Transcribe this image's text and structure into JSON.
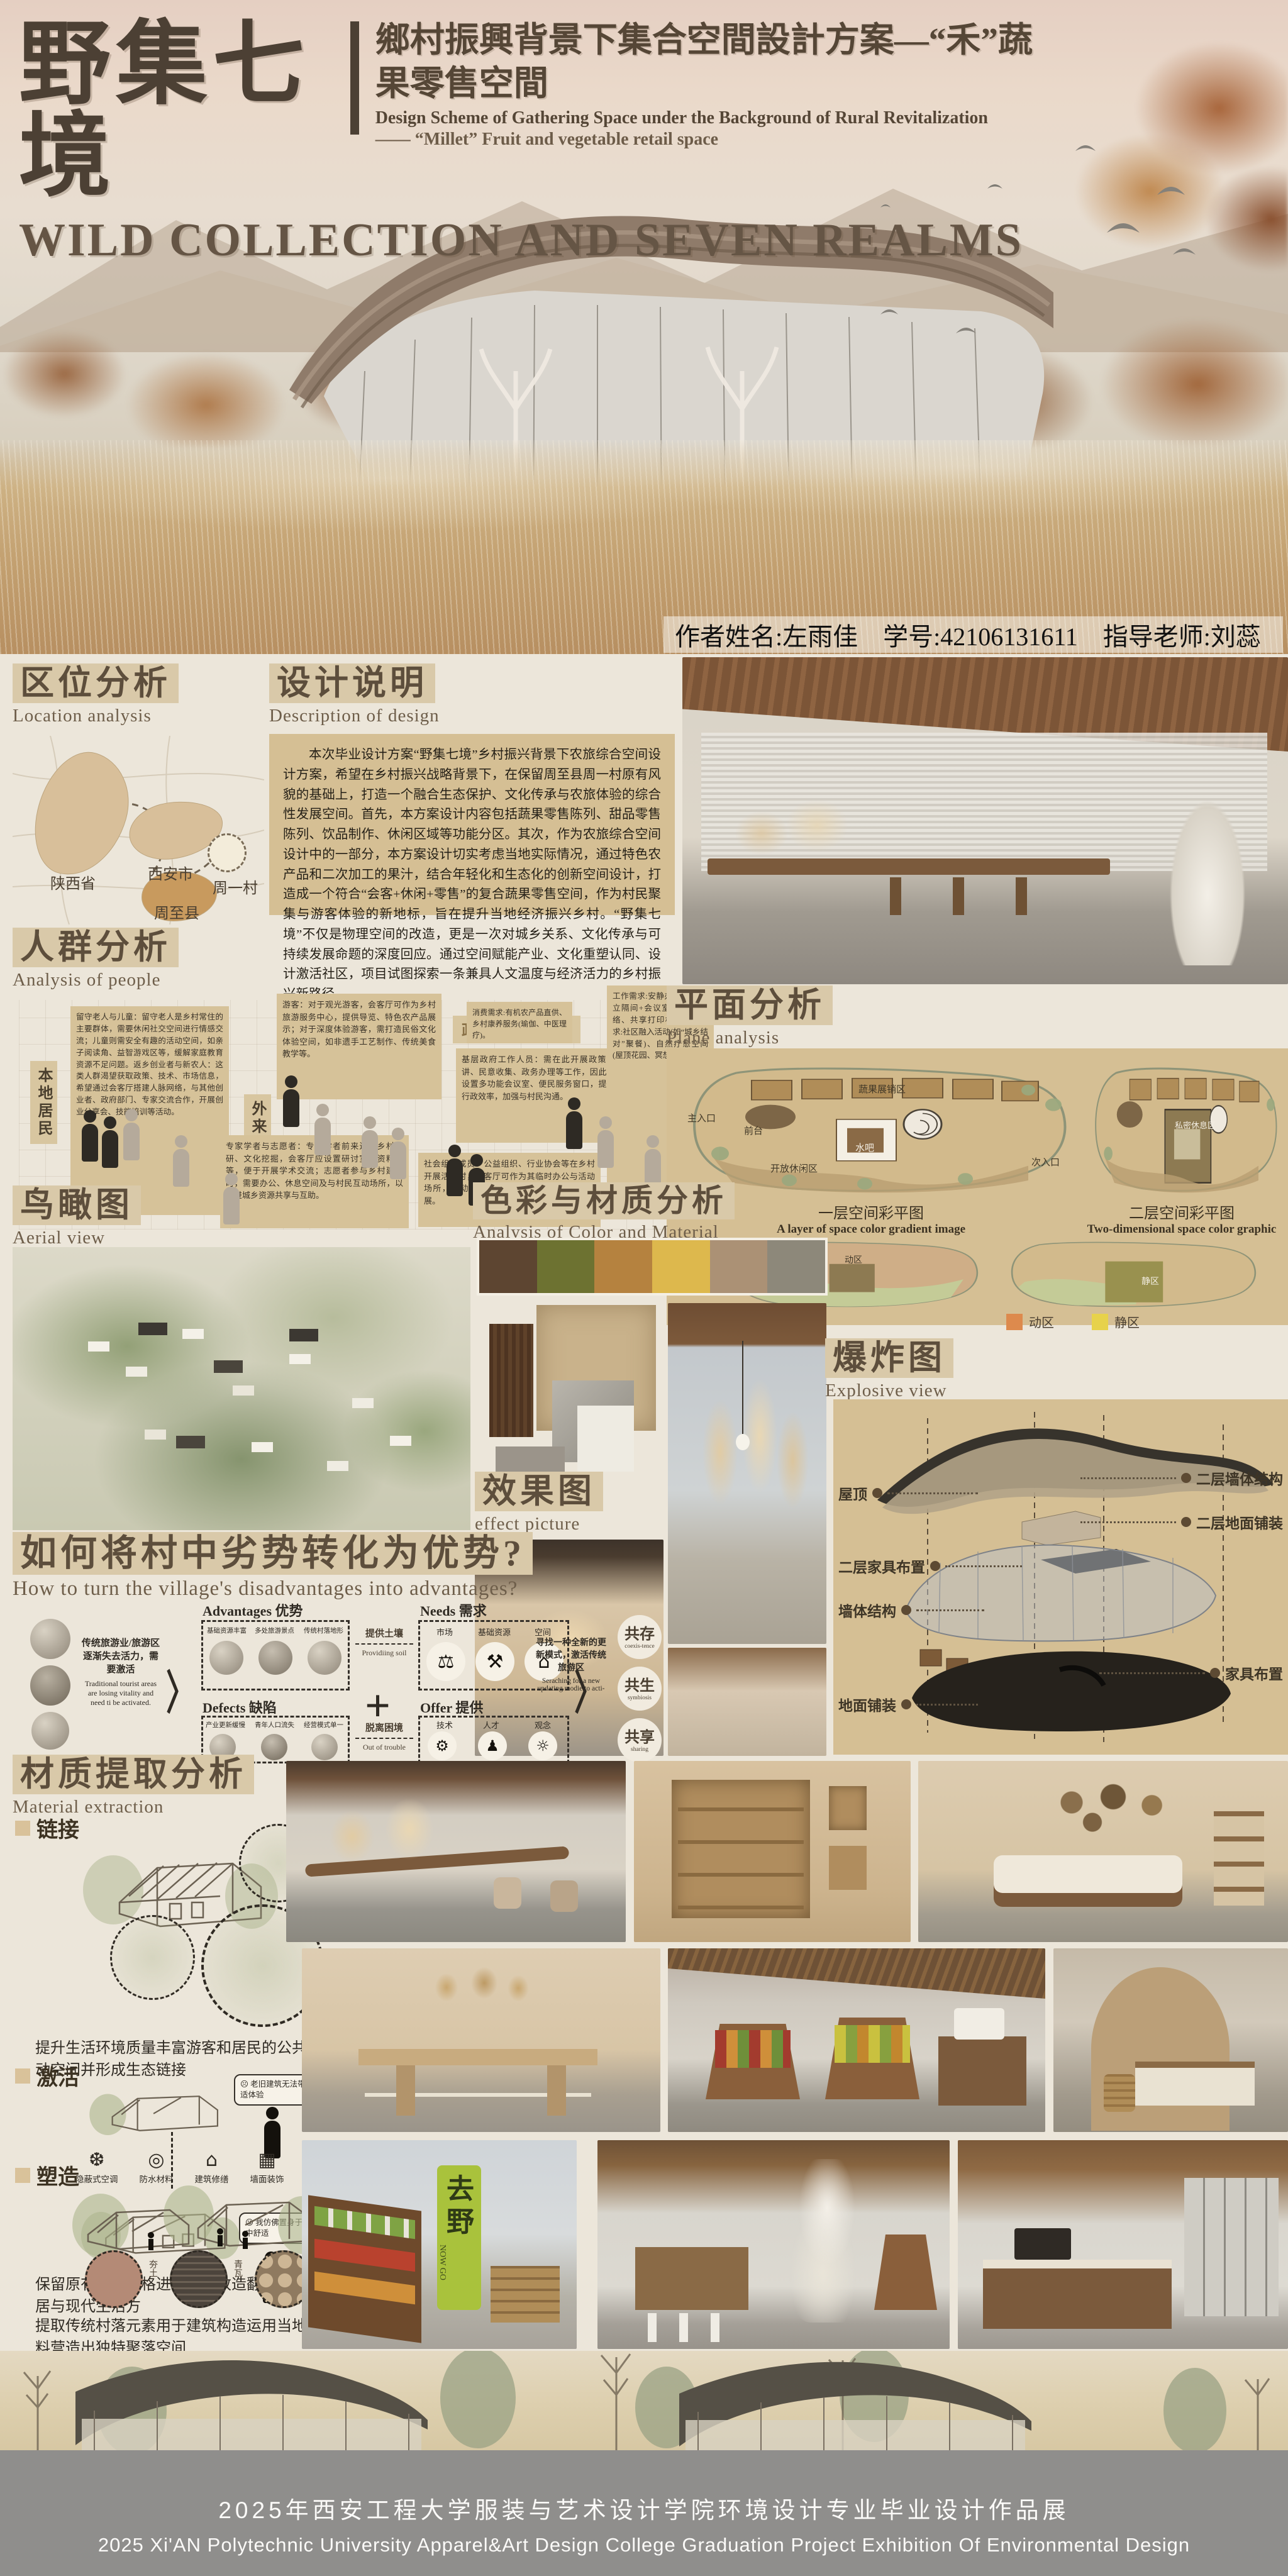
{
  "header": {
    "title_cn": "野集七境",
    "subtitle_cn": "鄉村振興背景下集合空間設計方案—“禾”蔬果零售空間",
    "subtitle_en1": "Design Scheme of Gathering Space under the Background of Rural Revitalization",
    "subtitle_en2": "—— “Millet” Fruit and vegetable retail space",
    "title_en": "WILD COLLECTION AND SEVEN REALMS"
  },
  "author": {
    "name": "作者姓名:左雨佳",
    "id": "学号:42106131611",
    "tutor": "指导老师:刘蕊"
  },
  "location": {
    "title": "区位分析",
    "subtitle": "Location analysis",
    "labels": {
      "province": "陕西省",
      "city": "西安市",
      "county": "周至县",
      "village": "周一村"
    }
  },
  "design": {
    "title": "设计说明",
    "subtitle": "Description of design",
    "paragraph": "本次毕业设计方案“野集七境”乡村振兴背景下农旅综合空间设计方案，希望在乡村振兴战略背景下，在保留周至县周一村原有风貌的基础上，打造一个融合生态保护、文化传承与农旅体验的综合性发展空间。首先，本方案设计内容包括蔬果零售陈列、甜品零售陈列、饮品制作、休闲区域等功能分区。其次，作为农旅综合空间设计中的一部分，本方案设计切实考虑当地实际情况，通过特色农产品和二次加工的果汁，结合年轻化和生态化的创新空间设计，打造成一个符合“会客+休闲+零售”的复合蔬果零售空间，作为村民聚集与游客体验的新地标，旨在提升当地经济振兴乡村。“野集七境”不仅是物理空间的改造，更是一次对城乡关系、文化传承与可持续发展命题的深度回应。通过空间赋能产业、文化重塑认同、设计激活社区，项目试图探索一条兼具人文温度与经济活力的乡村振兴新路径。"
  },
  "people": {
    "title": "人群分析",
    "subtitle": "Analysis of people",
    "group_local": "本地居民",
    "group_outside": "外来群体",
    "group_gov": "政府与社会组织",
    "group_newcomer": "城市新移民/远程工作者",
    "box_elder": "留守老人与儿童：留守老人是乡村常住的主要群体，需要休闲社交空间进行情感交流；儿童则需安全有趣的活动空间，如亲子阅读角、益智游戏区等，缓解家庭教育资源不足问题。返乡创业者与新农人：这类人群渴望获取政策、技术、市场信息，希望通过会客厅搭建人脉网络，与其他创业者、政府部门、专家交流合作，开展创业分享会、技能培训等活动。",
    "box_tourist": "游客：对于观光游客，会客厅可作为乡村旅游服务中心，提供导览、特色农产品展示；对于深度体验游客，需打造民俗文化体验空间，如非遗手工艺制作、传统美食教学等。",
    "box_gov": "基层政府工作人员：需在此开展政策宣讲、民意收集、政务办理等工作，因此需设置多功能会议室、便民服务窗口，提高行政效率，加强与村民沟通。",
    "box_org": "社会组织成员：公益组织、行业协会等在乡村开展活动时，会客厅可作为其临时办公与活动场所，推动公益项目落地，助力乡村产业发展。",
    "box_expert": "专家学者与志愿者：专家学者前来进行乡村调研、文化挖掘，会客厅应设置研讨室、资料室等，便于开展学术交流；志愿者参与乡村建设时，需要办公、休息空间及与村民互动场所，以促进城乡资源共享与互助。",
    "box_consume": "消费需求:有机农产品直供、乡村康养服务(瑜伽、中医理疗)。",
    "box_work": "工作需求:安静办公环境(独立隔间+会议室)、稳定网络、共享打印机；生活需求:社区融入活动(如“城乡结对”聚餐)、自然疗愈空间(屋顶花园、冥想角);"
  },
  "plane": {
    "title": "平面分析",
    "subtitle": "Plane analysis",
    "caption1_cn": "一层空间彩平图",
    "caption1_en": "A layer of space color gradient image",
    "caption2_cn": "二层空间彩平图",
    "caption2_en": "Two-dimensional space color graphic",
    "legend": [
      {
        "label": "动区",
        "color": "#dd8a4d"
      },
      {
        "label": "静区",
        "color": "#e7d24b"
      }
    ],
    "labels": {
      "main_entry": "主入口",
      "front_desk": "前台",
      "display_area": "蔬果展销区",
      "water_bar": "水吧",
      "open_lounge": "开放休闲区",
      "side_entry": "次入口",
      "private_rest": "私密休息区",
      "active": "动区",
      "quiet": "静区"
    }
  },
  "aerial": {
    "title": "鸟瞰图",
    "subtitle": "Aerial view"
  },
  "colormat": {
    "title": "色彩与材质分析",
    "subtitle": "Analysis of Color and Material",
    "palette": [
      "#5d4531",
      "#6d7231",
      "#b5823f",
      "#ddb84d",
      "#ab9175",
      "#8d887a"
    ]
  },
  "effect": {
    "title": "效果图",
    "subtitle": "effect picture"
  },
  "explosive": {
    "title": "爆炸图",
    "subtitle": "Explosive view",
    "labels_left": [
      "屋顶",
      "二层家具布置",
      "墙体结构",
      "地面铺装"
    ],
    "labels_right": [
      "二层墙体结构",
      "二层地面铺装",
      "家具布置"
    ]
  },
  "transform": {
    "title": "如何将村中劣势转化为优势?",
    "subtitle": "How to turn the village's disadvantages into advantages?",
    "left_cn": "传统旅游业/旅游区逐渐失去活力，需要激活",
    "left_en": "Traditional tourist areas are losing vitality and need ti be activated.",
    "adv_label": "Advantages 优势",
    "adv_items": [
      "基础资源丰富",
      "多处旅游景点",
      "传统村落地形"
    ],
    "arrow1_cn": "提供土壤",
    "arrow1_en": "Providiing soil",
    "needs_label": "Needs 需求",
    "needs_items": [
      {
        "icon": "⚖",
        "label": "市场"
      },
      {
        "icon": "⚒",
        "label": "基础资源"
      },
      {
        "icon": "⌂",
        "label": "空间"
      }
    ],
    "def_label": "Defects 缺陷",
    "def_items": [
      "产业更新缓慢",
      "青年人口流失",
      "经营模式单一"
    ],
    "arrow2_cn": "脱离困境",
    "arrow2_en": "Out of trouble",
    "offer_label": "Offer 提供",
    "offer_items": [
      {
        "icon": "⚙",
        "label": "技术"
      },
      {
        "icon": "♟",
        "label": "人才"
      },
      {
        "icon": "☼",
        "label": "观念"
      }
    ],
    "plus": "+",
    "right_cn": "寻找一种全新的更新模式，激活传统旅游区",
    "right_en": "Seraching for a new updating modie to acti-",
    "results": [
      {
        "cn": "共存",
        "en": "coexis-tence"
      },
      {
        "cn": "共生",
        "en": "symbiosis"
      },
      {
        "cn": "共享",
        "en": "sharing"
      }
    ]
  },
  "material": {
    "title": "材质提取分析",
    "subtitle": "Material extraction",
    "s1": "链接",
    "s1_caption": "提升生活环境质量丰富游客和居民的公共活动空间并形成生态链接",
    "s2": "激活",
    "bubble1_face": "☹",
    "bubble1": "老旧建筑无法带来舒适体验",
    "bubble2_face": "☺",
    "bubble2": "我仿佛置身于桃花源中舒适",
    "icons": [
      {
        "glyph": "❆",
        "label": "隐蔽式空调"
      },
      {
        "glyph": "◎",
        "label": "防水材料"
      },
      {
        "glyph": "⌂",
        "label": "建筑修缮"
      },
      {
        "glyph": "▦",
        "label": "墙面装饰"
      }
    ],
    "s2_caption": "保留原有建筑风格进行建筑改造翻新传统民居与现代生活方",
    "s3": "塑造",
    "materials": [
      "夯土",
      "青瓦",
      "木材"
    ],
    "s3_caption": "提取传统村落元素用于建筑构造运用当地材料营造出独特聚落空间"
  },
  "photos": {
    "banner_cn": "去野",
    "banner_en": "NOW GO"
  },
  "footer": {
    "line1": "2025年西安工程大学服装与艺术设计学院环境设计专业毕业设计作品展",
    "line2": "2025 Xi'AN Polytechnic University  Apparel&Art  Design  College Graduation Project Exhibition Of Environmental Design"
  }
}
